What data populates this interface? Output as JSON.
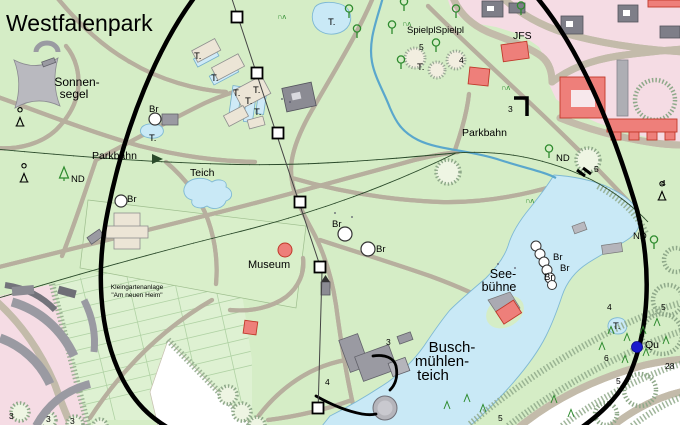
{
  "title": "Westfalenpark",
  "colors": {
    "park_green": "#d5edc6",
    "allotment_green": "#def1d2",
    "urban_pink": "#f5dce4",
    "water_blue": "#c9e9f6",
    "building_red": "#ee7f7a",
    "building_gray": "#9a9aa2",
    "overlay_black": "#000000",
    "railway_green": "#2a4a2a",
    "tree_green": "#2e8b2e",
    "spring_blue": "#1a1acc"
  },
  "labels": [
    {
      "text": "Westfalenpark",
      "x": 6,
      "y": 31,
      "size": 23,
      "name": "park-title"
    },
    {
      "text": "Sonnen-",
      "x": 77,
      "y": 86,
      "size": 12,
      "anchor": "middle",
      "name": "label-sonnensegel"
    },
    {
      "text": "segel",
      "x": 74,
      "y": 98,
      "size": 12,
      "anchor": "middle",
      "name": "label-sonnensegel"
    },
    {
      "text": "Parkbahn",
      "x": 92,
      "y": 159,
      "size": 10.5,
      "name": "label-parkbahn-west"
    },
    {
      "text": "Parkbahn",
      "x": 462,
      "y": 136,
      "size": 10.5,
      "name": "label-parkbahn-east"
    },
    {
      "text": "Teich",
      "x": 190,
      "y": 176,
      "size": 10.5,
      "name": "label-teich"
    },
    {
      "text": "Museum",
      "x": 248,
      "y": 268,
      "size": 11,
      "name": "label-museum"
    },
    {
      "text": "SpielplSpielpl",
      "x": 407,
      "y": 33,
      "size": 9.5,
      "name": "label-spielplatz"
    },
    {
      "text": "JFS",
      "x": 513,
      "y": 39,
      "size": 10.5,
      "name": "label-jfs"
    },
    {
      "text": "See-",
      "x": 503,
      "y": 278,
      "size": 12.5,
      "anchor": "middle",
      "name": "label-seebuehne"
    },
    {
      "text": "bühne",
      "x": 499,
      "y": 291,
      "size": 12.5,
      "anchor": "middle",
      "name": "label-seebuehne"
    },
    {
      "text": "Busch-",
      "x": 452,
      "y": 352,
      "size": 15,
      "anchor": "middle",
      "name": "label-buschmuehlenteich"
    },
    {
      "text": "mühlen-",
      "x": 442,
      "y": 366,
      "size": 15,
      "anchor": "middle",
      "name": "label-buschmuehlenteich"
    },
    {
      "text": "teich",
      "x": 433,
      "y": 380,
      "size": 15,
      "anchor": "middle",
      "name": "label-buschmuehlenteich"
    },
    {
      "text": "Kleingartenanlage",
      "x": 137,
      "y": 289,
      "size": 6.5,
      "anchor": "middle",
      "name": "label-kleingarten"
    },
    {
      "text": "\"Am neuen Heim\"",
      "x": 137,
      "y": 297,
      "size": 6.5,
      "anchor": "middle",
      "name": "label-kleingarten"
    },
    {
      "text": "Qu",
      "x": 645,
      "y": 348,
      "size": 10.5,
      "name": "label-spring"
    },
    {
      "text": "ND",
      "x": 71,
      "y": 182,
      "size": 9.5,
      "name": "label-nd"
    },
    {
      "text": "ND",
      "x": 556,
      "y": 161,
      "size": 9.5,
      "name": "label-nd"
    },
    {
      "text": "ND",
      "x": 633,
      "y": 239,
      "size": 9.5,
      "name": "label-nd"
    },
    {
      "text": "Br",
      "x": 127,
      "y": 202,
      "size": 9.5,
      "name": "label-fountain"
    },
    {
      "text": "Br",
      "x": 149,
      "y": 112,
      "size": 9.5,
      "name": "label-fountain"
    },
    {
      "text": "Br",
      "x": 332,
      "y": 227,
      "size": 9.5,
      "name": "label-fountain"
    },
    {
      "text": "Br",
      "x": 376,
      "y": 252,
      "size": 9.5,
      "name": "label-fountain"
    },
    {
      "text": "Br",
      "x": 553,
      "y": 260,
      "size": 9.5,
      "name": "label-fountain"
    },
    {
      "text": "Br",
      "x": 560,
      "y": 271,
      "size": 9.5,
      "name": "label-fountain"
    },
    {
      "text": "Br",
      "x": 544,
      "y": 280,
      "size": 9.5,
      "name": "label-fountain"
    },
    {
      "text": "T.",
      "x": 328,
      "y": 25,
      "size": 9.5,
      "name": "label-t"
    },
    {
      "text": "T.",
      "x": 194,
      "y": 59,
      "size": 9.5,
      "name": "label-t"
    },
    {
      "text": "T.",
      "x": 211,
      "y": 81,
      "size": 9.5,
      "name": "label-t"
    },
    {
      "text": "T.",
      "x": 233,
      "y": 96,
      "size": 9.5,
      "name": "label-t"
    },
    {
      "text": "T.",
      "x": 253,
      "y": 93,
      "size": 9.5,
      "name": "label-t"
    },
    {
      "text": "T.",
      "x": 245,
      "y": 104,
      "size": 9.5,
      "name": "label-t"
    },
    {
      "text": "T.",
      "x": 254,
      "y": 115,
      "size": 9.5,
      "name": "label-t"
    },
    {
      "text": "T.",
      "x": 149,
      "y": 141,
      "size": 9.5,
      "name": "label-t"
    },
    {
      "text": "T.",
      "x": 417,
      "y": 70,
      "size": 9.5,
      "name": "label-t"
    },
    {
      "text": "T.",
      "x": 613,
      "y": 329,
      "size": 9.5,
      "name": "label-t"
    },
    {
      "text": "4",
      "x": 459,
      "y": 63,
      "size": 8.5,
      "name": "path-number"
    },
    {
      "text": "3",
      "x": 508,
      "y": 112,
      "size": 8.5,
      "name": "path-number"
    },
    {
      "text": "5",
      "x": 419,
      "y": 50,
      "size": 8.5,
      "name": "path-number"
    },
    {
      "text": "5",
      "x": 594,
      "y": 172,
      "size": 8.5,
      "name": "path-number"
    },
    {
      "text": "4",
      "x": 661,
      "y": 186,
      "size": 8.5,
      "name": "path-number"
    },
    {
      "text": "4",
      "x": 607,
      "y": 310,
      "size": 8.5,
      "name": "path-number"
    },
    {
      "text": "5",
      "x": 661,
      "y": 310,
      "size": 8.5,
      "name": "path-number"
    },
    {
      "text": "6",
      "x": 604,
      "y": 361,
      "size": 8.5,
      "name": "path-number"
    },
    {
      "text": "28",
      "x": 665,
      "y": 369,
      "size": 8.5,
      "name": "path-number"
    },
    {
      "text": "5",
      "x": 616,
      "y": 384,
      "size": 8.5,
      "name": "path-number"
    },
    {
      "text": "5",
      "x": 498,
      "y": 421,
      "size": 8.5,
      "name": "path-number"
    },
    {
      "text": "3",
      "x": 9,
      "y": 419,
      "size": 8.5,
      "name": "path-number"
    },
    {
      "text": "3",
      "x": 46,
      "y": 422,
      "size": 8.5,
      "name": "path-number"
    },
    {
      "text": "3",
      "x": 70,
      "y": 424,
      "size": 8.5,
      "name": "path-number"
    },
    {
      "text": "3",
      "x": 386,
      "y": 345,
      "size": 8.5,
      "name": "path-number"
    },
    {
      "text": "4",
      "x": 325,
      "y": 385,
      "size": 8.5,
      "name": "path-number"
    },
    {
      "text": "∩ʌ",
      "x": 277,
      "y": 19,
      "size": 7.5,
      "color": "#2e8b2e",
      "name": "shrub-glyph"
    },
    {
      "text": "∩ʌ",
      "x": 402,
      "y": 26,
      "size": 7.5,
      "color": "#2e8b2e",
      "name": "shrub-glyph"
    },
    {
      "text": "∩ʌ",
      "x": 525,
      "y": 203,
      "size": 7.5,
      "color": "#2e8b2e",
      "name": "shrub-glyph"
    },
    {
      "text": "∩ʌ",
      "x": 501,
      "y": 90,
      "size": 7.5,
      "color": "#2e8b2e",
      "name": "shrub-glyph"
    }
  ],
  "markers": {
    "fountains": [
      {
        "x": 121,
        "y": 201,
        "r": 6
      },
      {
        "x": 155,
        "y": 119,
        "r": 6
      },
      {
        "x": 345,
        "y": 234,
        "r": 7
      },
      {
        "x": 368,
        "y": 249,
        "r": 7
      }
    ],
    "fountain_chain": [
      {
        "x": 536,
        "y": 246,
        "r": 5
      },
      {
        "x": 540,
        "y": 254,
        "r": 5
      },
      {
        "x": 544,
        "y": 262,
        "r": 5
      },
      {
        "x": 547,
        "y": 270,
        "r": 5
      },
      {
        "x": 550,
        "y": 278,
        "r": 5
      },
      {
        "x": 552,
        "y": 285,
        "r": 4.5
      }
    ],
    "museum_dot": {
      "x": 285,
      "y": 250,
      "r": 7
    },
    "spring_dot": {
      "x": 637,
      "y": 347,
      "r": 5.5
    },
    "cable_pylons": [
      {
        "x": 237,
        "y": 17
      },
      {
        "x": 257,
        "y": 73
      },
      {
        "x": 278,
        "y": 133
      },
      {
        "x": 300,
        "y": 202
      },
      {
        "x": 320,
        "y": 267
      },
      {
        "x": 318,
        "y": 408
      }
    ],
    "monuments": [
      {
        "x": 20,
        "y": 121
      },
      {
        "x": 24,
        "y": 177
      },
      {
        "x": 662,
        "y": 195
      }
    ],
    "trees_deciduous": [
      {
        "x": 349,
        "y": 12
      },
      {
        "x": 357,
        "y": 32
      },
      {
        "x": 392,
        "y": 28
      },
      {
        "x": 404,
        "y": 5
      },
      {
        "x": 456,
        "y": 12
      },
      {
        "x": 436,
        "y": 46
      },
      {
        "x": 401,
        "y": 63
      },
      {
        "x": 521,
        "y": 9
      },
      {
        "x": 549,
        "y": 152
      },
      {
        "x": 654,
        "y": 243
      }
    ],
    "conifer_nd": {
      "x": 64,
      "y": 175
    },
    "small_conifers": [
      {
        "x": 611,
        "y": 331
      },
      {
        "x": 627,
        "y": 338
      },
      {
        "x": 643,
        "y": 331
      },
      {
        "x": 657,
        "y": 323
      },
      {
        "x": 666,
        "y": 341
      },
      {
        "x": 602,
        "y": 347
      },
      {
        "x": 646,
        "y": 353
      },
      {
        "x": 467,
        "y": 399
      },
      {
        "x": 483,
        "y": 409
      },
      {
        "x": 447,
        "y": 406
      },
      {
        "x": 554,
        "y": 400
      },
      {
        "x": 571,
        "y": 414
      },
      {
        "x": 625,
        "y": 360
      }
    ],
    "dots": [
      {
        "x": 335,
        "y": 213
      },
      {
        "x": 352,
        "y": 217
      },
      {
        "x": 498,
        "y": 264
      },
      {
        "x": 515,
        "y": 268
      },
      {
        "x": 290,
        "y": 102
      },
      {
        "x": 282,
        "y": 99
      }
    ]
  }
}
